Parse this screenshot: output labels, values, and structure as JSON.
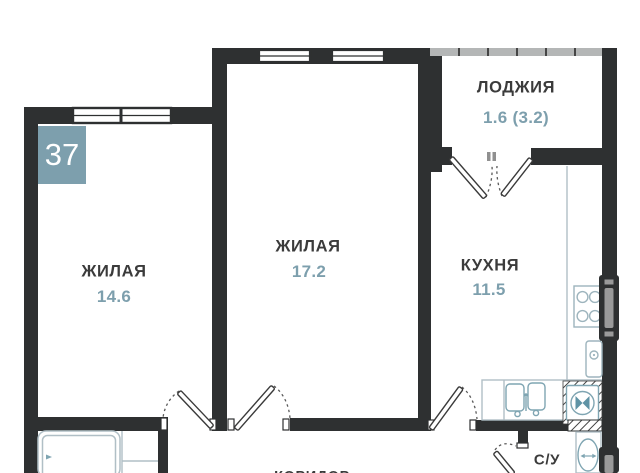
{
  "unit": {
    "number": "37"
  },
  "rooms": {
    "living1": {
      "label": "ЖИЛАЯ",
      "area": "14.6"
    },
    "living2": {
      "label": "ЖИЛАЯ",
      "area": "17.2"
    },
    "kitchen": {
      "label": "КУХНЯ",
      "area": "11.5"
    },
    "loggia": {
      "label": "ЛОДЖИЯ",
      "area": "1.6 (3.2)"
    },
    "bathroom": {
      "label": "С/У"
    },
    "corridor": {
      "label": "КОРИДОР"
    }
  },
  "colors": {
    "accent": "#7d9fad",
    "wall": "#2e3031",
    "fixture_light": "#b0bfc6",
    "fixture_teal": "#7fa5b2"
  }
}
